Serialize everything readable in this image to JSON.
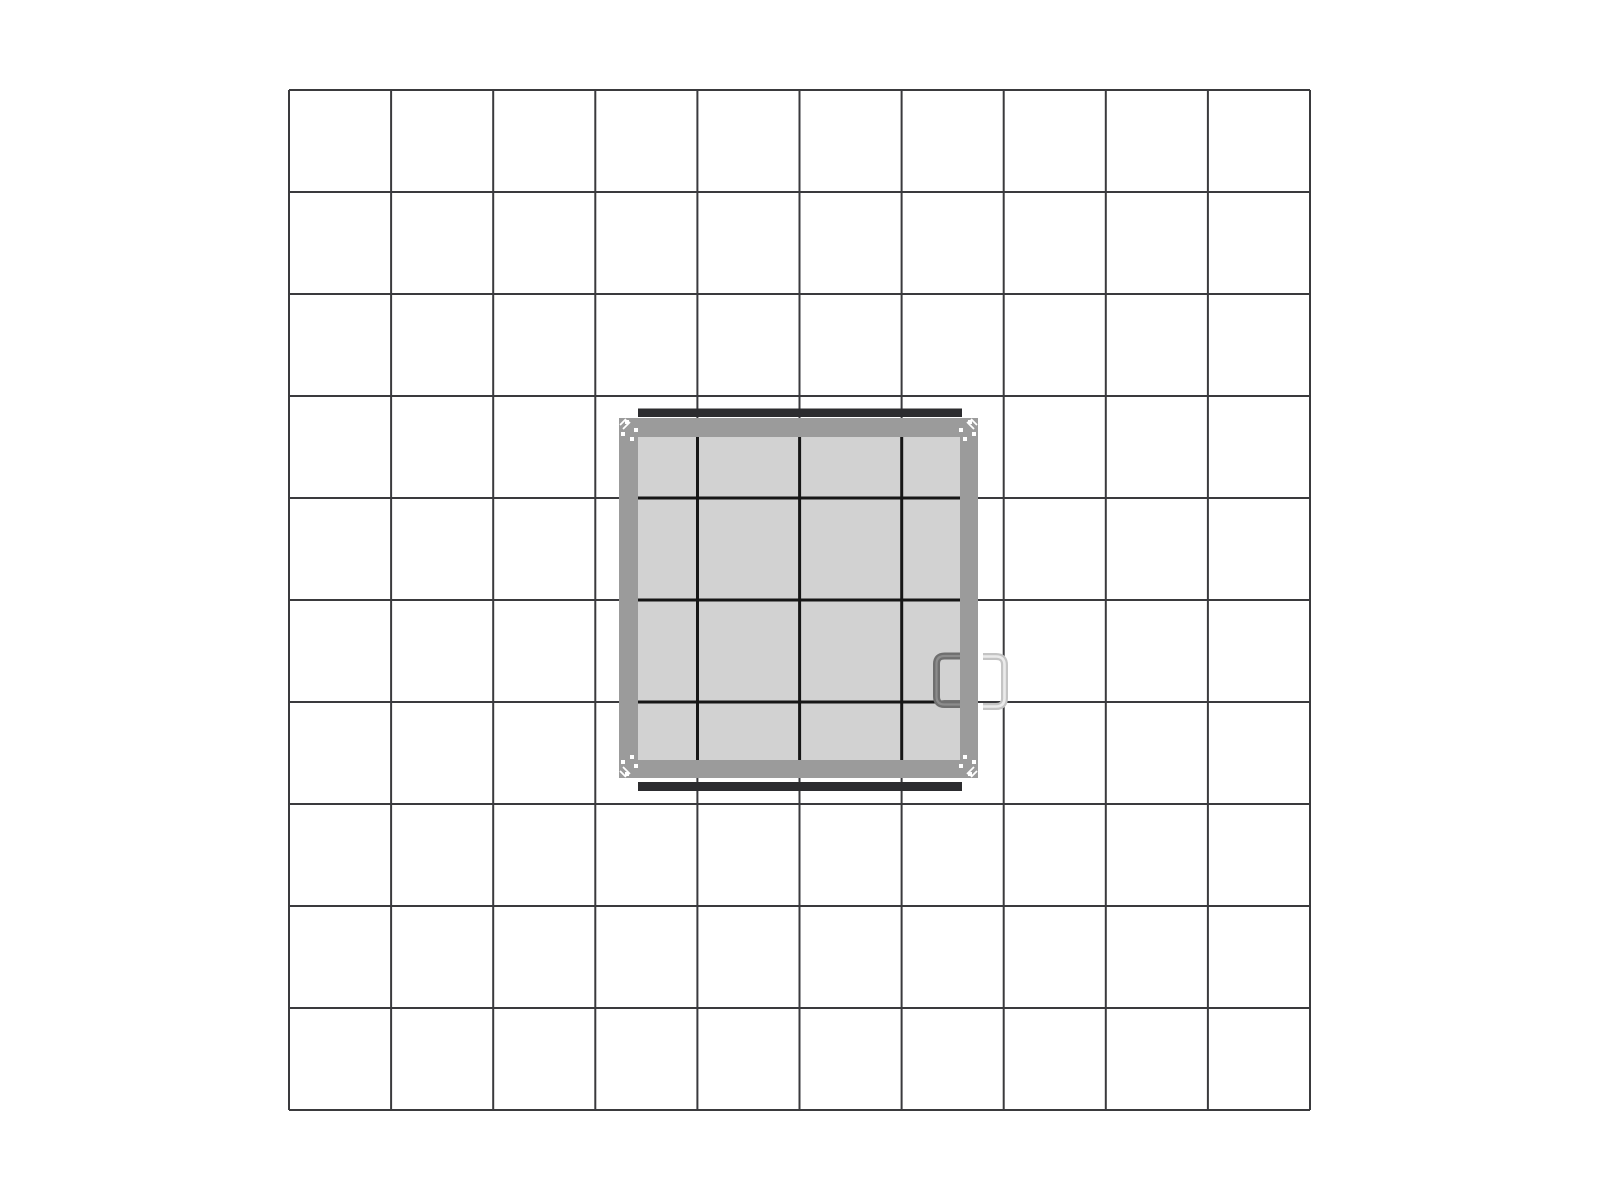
{
  "canvas": {
    "width": 1600,
    "height": 1200,
    "background": "#ffffff"
  },
  "grid": {
    "x": 289,
    "y": 90,
    "cols": 10,
    "rows": 10,
    "cell_w": 102.1,
    "cell_h": 102.0,
    "line_color": "#3a3a3d",
    "line_width": 2
  },
  "hatch": {
    "frame": {
      "x": 619,
      "y": 418,
      "width": 359,
      "height": 360,
      "color": "#9b9b9b"
    },
    "panel": {
      "x": 638,
      "y": 437,
      "width": 322,
      "height": 323,
      "color": "#d2d2d2"
    },
    "panel_mullions": {
      "color": "#161616",
      "width": 3,
      "vertical_x": [
        697.5,
        799.6,
        901.7
      ],
      "horizontal_y": [
        498,
        600,
        702
      ]
    },
    "top_bar": {
      "x": 638,
      "y": 408.5,
      "width": 324,
      "height": 8.5,
      "color": "#2c2c2f"
    },
    "bottom_bar": {
      "x": 638,
      "y": 782,
      "width": 324,
      "height": 9,
      "color": "#2c2c2f"
    },
    "corner_fasteners": {
      "color": "#ffffff",
      "square_size": 4,
      "square_offsets": [
        [
          6,
          2
        ],
        [
          15,
          10
        ],
        [
          2,
          14
        ],
        [
          11,
          19
        ]
      ],
      "dash_offsets": [
        [
          1,
          7,
          7,
          1
        ],
        [
          4,
          11,
          11,
          4
        ]
      ],
      "dash_width": 1.8,
      "corners": [
        {
          "cx": 619,
          "cy": 418,
          "sx": 1,
          "sy": 1
        },
        {
          "cx": 978,
          "cy": 418,
          "sx": -1,
          "sy": 1
        },
        {
          "cx": 619,
          "cy": 778,
          "sx": 1,
          "sy": -1
        },
        {
          "cx": 978,
          "cy": 778,
          "sx": -1,
          "sy": -1
        }
      ]
    },
    "handle_inner": {
      "open_end_x": 968,
      "corner_x": 936.5,
      "top_y": 656,
      "bottom_y": 704.5,
      "radius": 8,
      "stroke": 7,
      "color": "#6f6f6f",
      "highlight": "#8c8c8c",
      "highlight_width": 2.2
    },
    "handle_outer": {
      "open_end_x": 983,
      "corner_x": 1004.5,
      "top_y": 656.5,
      "bottom_y": 706.5,
      "radius": 8.5,
      "stroke": 7,
      "color": "#c4c4c4",
      "highlight": "#ebebeb",
      "highlight_width": 2.6
    }
  }
}
